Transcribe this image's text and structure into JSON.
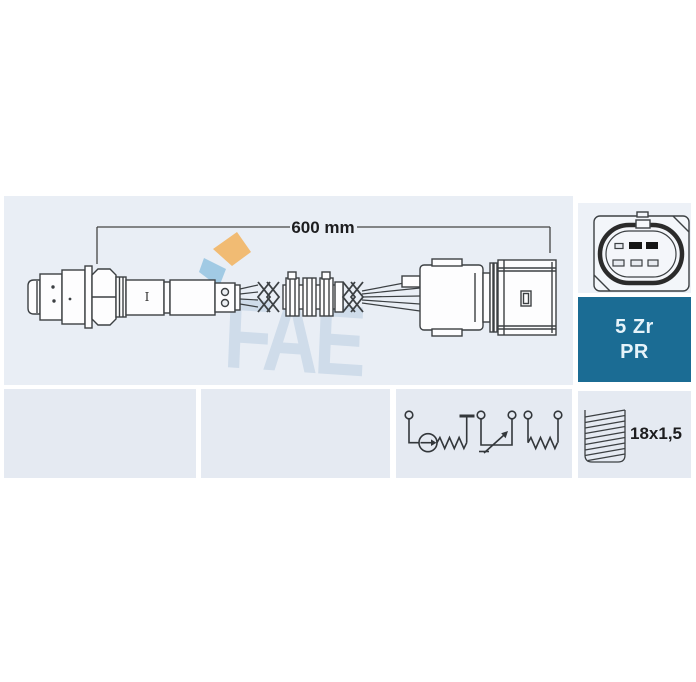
{
  "colors": {
    "panel_bg": "#e9eef5",
    "panel_bg_right": "#edf1f7",
    "panel_bg_bottom": "#e5eaf2",
    "badge_bg": "#1b6c94",
    "badge_text": "#e6f3fa",
    "line_art": "#3c4043",
    "label_text": "#1d1d1f",
    "watermark_blue": "#b6cbe0",
    "logo_orange": "#f2b25c",
    "logo_blue": "#8fc0e0"
  },
  "diagram_panel": {
    "dimension_label": "600 mm",
    "body_marking": "I",
    "watermark_text": "FAE",
    "icon": "oxygen-sensor-drawing"
  },
  "connector_panel": {
    "icon": "connector-face-5pin"
  },
  "badge": {
    "line1": "5 Zr",
    "line2": "PR"
  },
  "schematic_panel": {
    "icon": "sensor-wiring-schematic"
  },
  "thread_panel": {
    "icon": "thread-gauge",
    "spec_label": "18x1,5"
  }
}
